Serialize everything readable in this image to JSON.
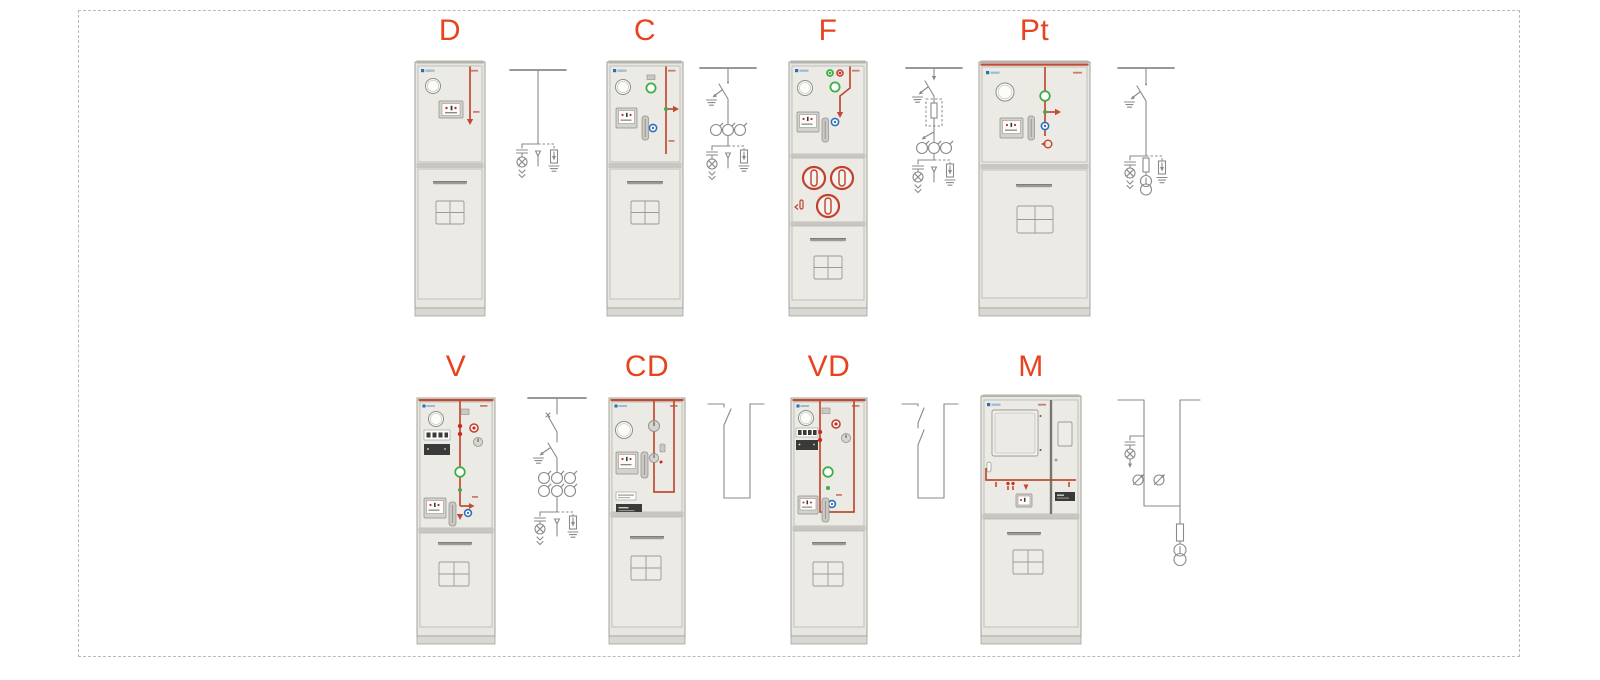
{
  "units": [
    {
      "id": "d",
      "label": "D"
    },
    {
      "id": "c",
      "label": "C"
    },
    {
      "id": "f",
      "label": "F"
    },
    {
      "id": "pt",
      "label": "Pt"
    },
    {
      "id": "v",
      "label": "V"
    },
    {
      "id": "cd",
      "label": "CD"
    },
    {
      "id": "vd",
      "label": "VD"
    },
    {
      "id": "m",
      "label": "M"
    }
  ],
  "colors": {
    "label_accent": "#e8431f",
    "mimic_red": "#c14a33",
    "schematic_line": "#8a8a8a",
    "cabinet_body": "#e7e6e1",
    "cabinet_border": "#a3a29b",
    "indicator_green": "#3fae49",
    "indicator_blue": "#2f6fba",
    "logo_blue": "#2e6db4",
    "frame_dash": "#b6bcbc"
  }
}
